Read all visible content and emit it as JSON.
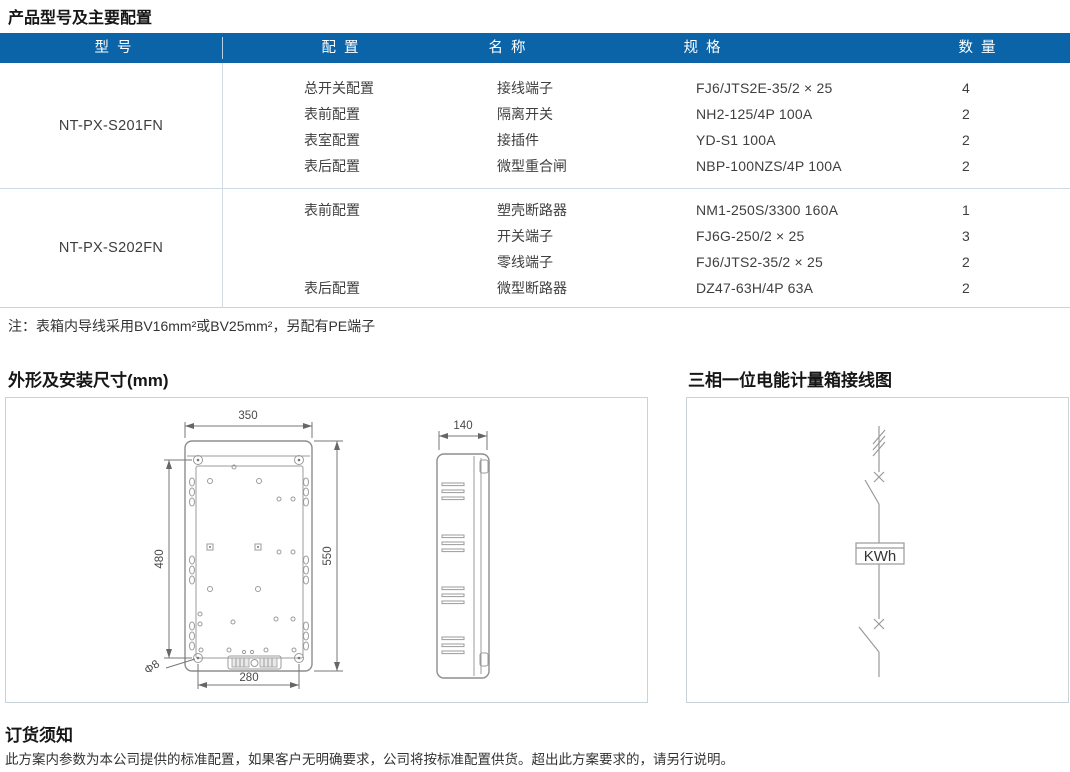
{
  "titles": {
    "main": "产品型号及主要配置",
    "dimensions": "外形及安装尺寸(mm)",
    "wiring": "三相一位电能计量箱接线图",
    "ordering": "订货须知"
  },
  "table": {
    "headers": {
      "model": "型 号",
      "config": "配 置",
      "name": "名 称",
      "spec": "规 格",
      "qty": "数 量"
    },
    "rows": [
      {
        "model": "NT-PX-S201FN",
        "items": [
          {
            "config": "总开关配置",
            "name": "接线端子",
            "spec": "FJ6/JTS2E-35/2 × 25",
            "qty": "4"
          },
          {
            "config": "表前配置",
            "name": "隔离开关",
            "spec": "NH2-125/4P 100A",
            "qty": "2"
          },
          {
            "config": "表室配置",
            "name": "接插件",
            "spec": "YD-S1 100A",
            "qty": "2"
          },
          {
            "config": "表后配置",
            "name": "微型重合闸",
            "spec": "NBP-100NZS/4P 100A",
            "qty": "2"
          }
        ]
      },
      {
        "model": "NT-PX-S202FN",
        "items": [
          {
            "config": "表前配置",
            "name": "塑壳断路器",
            "spec": "NM1-250S/3300  160A",
            "qty": "1"
          },
          {
            "config": "",
            "name": "开关端子",
            "spec": "FJ6G-250/2 × 25",
            "qty": "3"
          },
          {
            "config": "",
            "name": "零线端子",
            "spec": "FJ6/JTS2-35/2 × 25",
            "qty": "2"
          },
          {
            "config": "表后配置",
            "name": "微型断路器",
            "spec": "DZ47-63H/4P 63A",
            "qty": "2"
          }
        ]
      }
    ]
  },
  "note": "注：表箱内导线采用BV16mm²或BV25mm²，另配有PE端子",
  "ordering_text": "此方案内参数为本公司提供的标准配置，如果客户无明确要求，公司将按标准配置供货。超出此方案要求的，请另行说明。",
  "drawing_dims": {
    "width": "350",
    "mount_height": "480",
    "height": "550",
    "mount_width": "280",
    "hole_dia": "Φ8",
    "depth": "140"
  },
  "wiring_diagram": {
    "meter_label": "KWh"
  },
  "colors": {
    "header_bg": "#0c64a8",
    "header_text": "#ffffff",
    "row_border": "#ccdae6",
    "panel_border": "#c9d3da",
    "drawing_line": "#9b9b9b"
  }
}
